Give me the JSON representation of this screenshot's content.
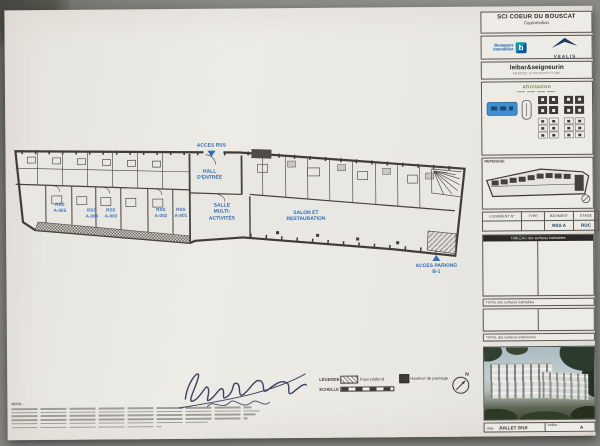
{
  "colors": {
    "label_blue": "#2e6cb5",
    "paper": "#ebe9e4",
    "line": "#45423e",
    "navy": "#1d3a5f",
    "bouygues_blue": "#0a57a0",
    "teal": "#0a9aa8"
  },
  "plan": {
    "access_rss": "ACCES RSS",
    "hall_line1": "HALL",
    "hall_line2": "D'ENTRÉE",
    "salle_line1": "SALLE",
    "salle_line2": "MULTI-",
    "salle_line3": "ACTIVITÉS",
    "salon_line1": "SALON ET",
    "salon_line2": "RESTAURATION",
    "parking_line1": "ACCES PARKING",
    "parking_line2": "B-1",
    "rooms": [
      {
        "l1": "RSS",
        "l2": "A-005"
      },
      {
        "l1": "RSS",
        "l2": "A-004"
      },
      {
        "l1": "RSS",
        "l2": "A-003"
      },
      {
        "l1": "RSS",
        "l2": "A-002"
      },
      {
        "l1": "RSS",
        "l2": "A-001"
      }
    ]
  },
  "legend": {
    "title": "LÉGENDE",
    "faux_plafond": "Faux plafond",
    "echelle": "ECHELLE",
    "passage": "Hauteur de passage",
    "north": "N"
  },
  "nota": {
    "title": "NOTA :"
  },
  "titleblock": {
    "project": {
      "title": "SCI COEUR DU BOUSCAT",
      "subtitle": "Copromotion"
    },
    "bouygues": {
      "line1": "Bouygues",
      "line2": "Immobilier"
    },
    "partner": {
      "name": "VEALIS"
    },
    "architect": {
      "name": "leibar&seigneurin",
      "subtitle": "AGENCE D'ARCHITECTURE"
    },
    "operator": {
      "name": "afinitation"
    },
    "reperage": "REPERAGE",
    "logement": {
      "headers": [
        "LOGEMENT  N°",
        "TYPE",
        "BATIMENT",
        "ETAGE"
      ],
      "values": [
        "",
        "",
        "RSS A",
        "RDC"
      ]
    },
    "surfaces": {
      "table_header": "TABLEAU des surfaces habitables",
      "total1": "TOTAL des surfaces habitables",
      "total2": "TOTAL des surfaces extérieures"
    },
    "daterow": {
      "date_label": "date",
      "date_value": "JUILLET 2019",
      "indice_label": "Indice :",
      "indice_value": "A"
    }
  }
}
